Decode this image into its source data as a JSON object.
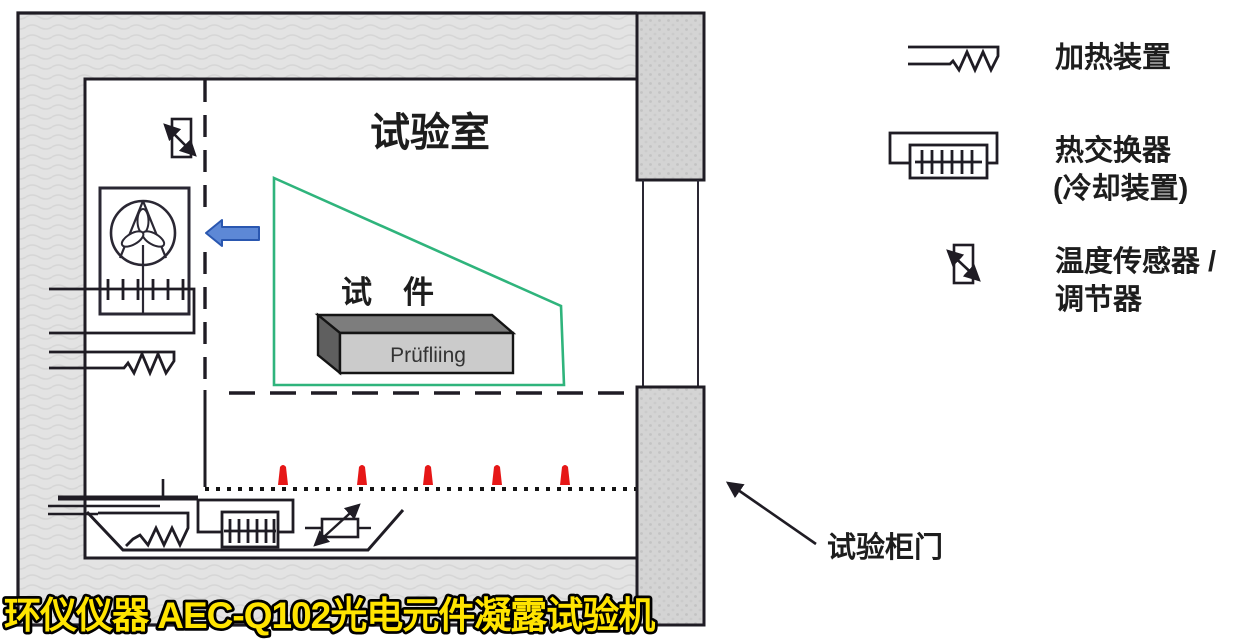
{
  "title_banner": "环仪仪器 AEC-Q102光电元件凝露试验机",
  "chamber": {
    "room_label": "试验室",
    "specimen_label": "试　件",
    "specimen_box_label": "Prüfliing",
    "door_callout_label": "试验柜门"
  },
  "legend": {
    "items": [
      {
        "icon": "heater-symbol",
        "label": "加热装置",
        "sublabel": ""
      },
      {
        "icon": "heat-exchanger-symbol",
        "label": "热交换器",
        "sublabel": "(冷却装置)"
      },
      {
        "icon": "temperature-sensor-symbol",
        "label": "温度传感器 /",
        "sublabel": "调节器"
      }
    ]
  },
  "colors": {
    "airflow_boundary_green": "#2fb47c",
    "airflow_arrow_blue": "#5d88d6",
    "condensation_red": "#e61717",
    "banner_yellow": "#ffe400",
    "wall_gray": "#e3e3e3",
    "door_gray": "#d4d4d4",
    "line_black": "#1f1c24"
  }
}
